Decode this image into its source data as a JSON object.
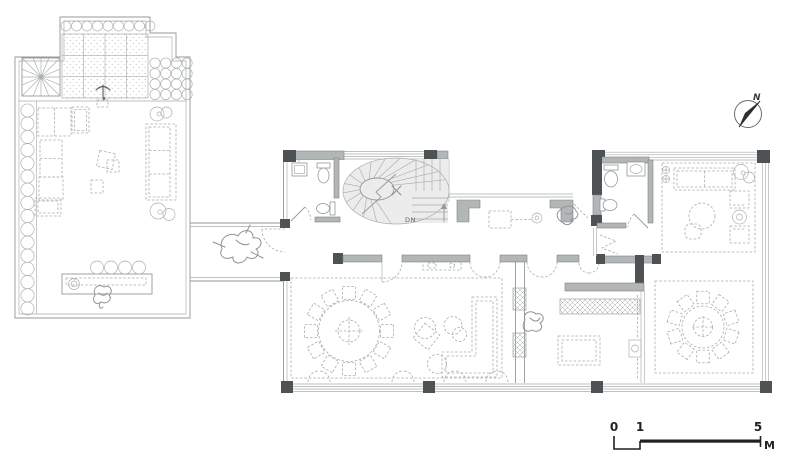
{
  "plan": {
    "title": "villa-first-floor-plan",
    "compass": {
      "label": "N"
    },
    "stair": {
      "direction_label": "DN"
    },
    "scale_bar": {
      "tick_labels": [
        "0",
        "1",
        "5"
      ],
      "unit_label": "M"
    },
    "colors": {
      "background": "#ffffff",
      "line": "#939899",
      "light_line": "#a9adae",
      "wall_fill": "#b3b6b7",
      "wall_edge": "#7c8284",
      "column_fill": "#4e5254",
      "dash": "#a9adae",
      "stair_fill": "#ececec",
      "label": "#5f6365",
      "scale_text": "#1f2122",
      "sketch": "#8e9496"
    }
  }
}
